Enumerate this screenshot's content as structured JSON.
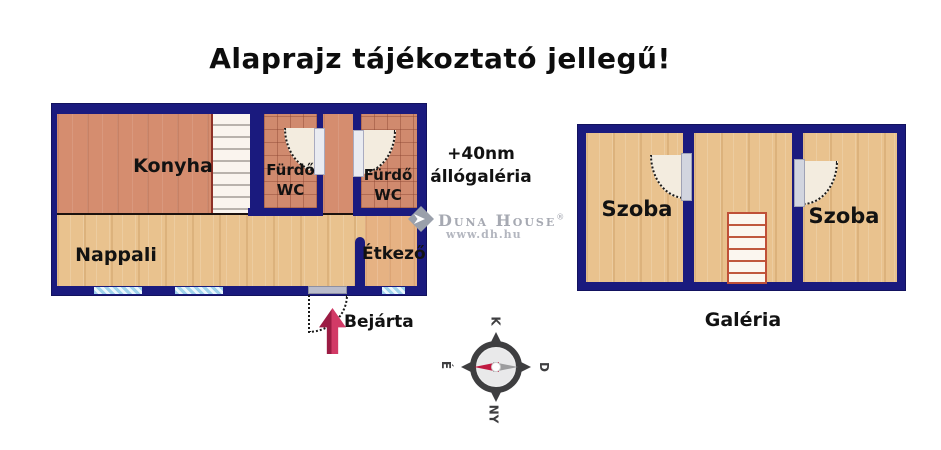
{
  "title": "Alaprajz tájékoztató jellegű!",
  "ground_floor": {
    "kitchen": "Konyha",
    "bathroom1": {
      "line1": "Fürdő",
      "line2": "WC"
    },
    "bathroom2": {
      "line1": "Fürdő",
      "line2": "WC"
    },
    "living_room": "Nappali",
    "dining_room": "Étkező",
    "entrance": "Bejárta"
  },
  "gallery": {
    "room_left": "Szoba",
    "room_right": "Szoba",
    "caption": "Galéria"
  },
  "note": {
    "line1": "+40nm",
    "line2": "állógaléria"
  },
  "brand": {
    "name": "Duna House",
    "reg": "®",
    "website": "www.dh.hu"
  },
  "compass": {
    "top": "K",
    "right": "D",
    "bottom": "NY",
    "left": "É"
  },
  "colors": {
    "wall": "#1a1a7e",
    "kitchen_floor": "#d58d6f",
    "tile_floor": "#d08a6e",
    "wood_floor": "#e9c28e",
    "dining_floor": "#e6b283",
    "window": "#9fd2ec",
    "entrance_arrow": "#c72a56",
    "compass_needle_red": "#c01a41",
    "compass_needle_gray": "#9c9c9e",
    "stair_outline": "#bf5038",
    "brand_gray": "#a6a9b2"
  }
}
